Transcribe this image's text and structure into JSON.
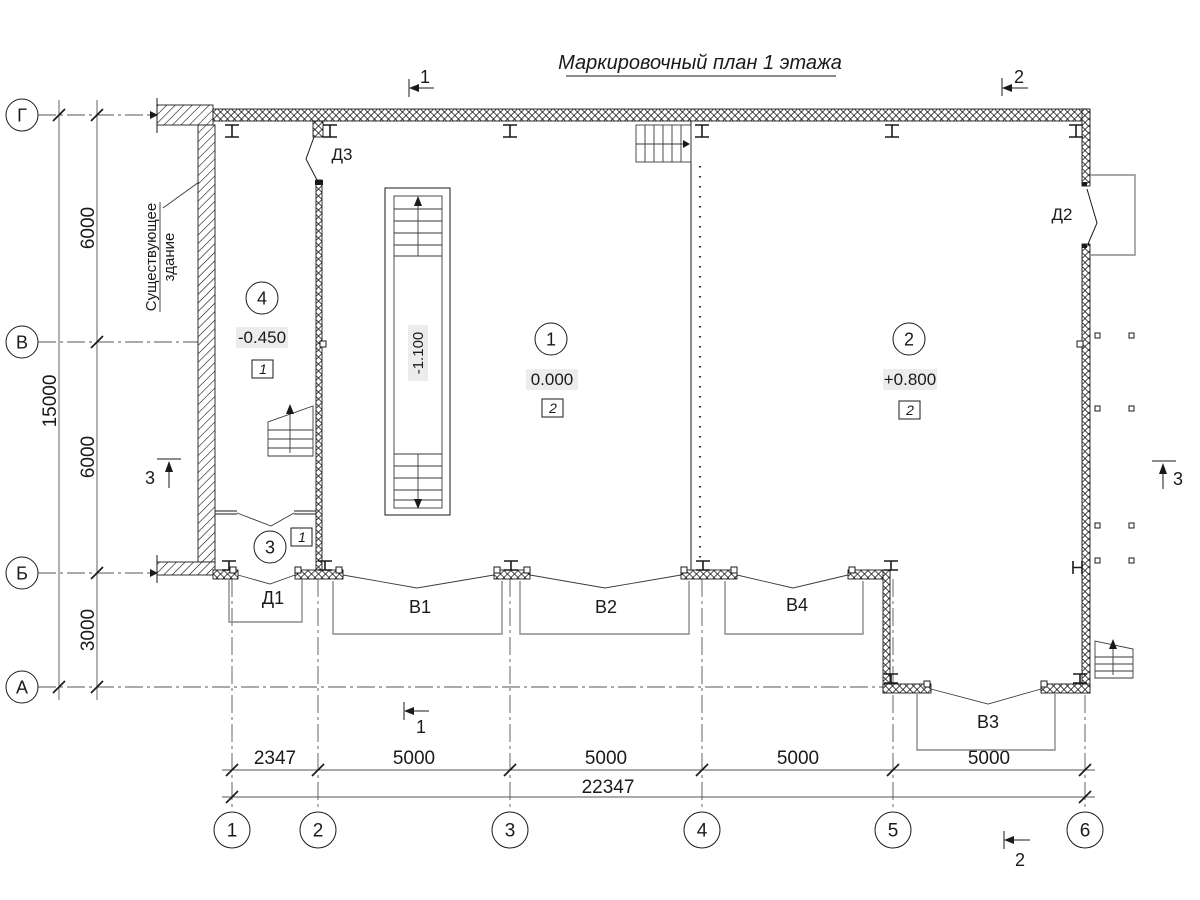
{
  "title": "Маркировочный план 1 этажа",
  "existing": {
    "line1": "Существующее",
    "line2": "здание"
  },
  "axes": {
    "cols": [
      "1",
      "2",
      "3",
      "4",
      "5",
      "6"
    ],
    "rows": [
      "Г",
      "В",
      "Б",
      "А"
    ]
  },
  "dims": {
    "h_segments": [
      "2347",
      "5000",
      "5000",
      "5000",
      "5000"
    ],
    "h_total": "22347",
    "v_segments": [
      "6000",
      "6000",
      "3000"
    ],
    "v_total": "15000"
  },
  "rooms": [
    {
      "num": "4",
      "elev": "-0.450",
      "type": "1"
    },
    {
      "num": "1",
      "elev": "0.000",
      "type": "2"
    },
    {
      "num": "2",
      "elev": "+0.800",
      "type": "2"
    },
    {
      "num": "3",
      "type": "1"
    }
  ],
  "pit": {
    "elev": "-1.100"
  },
  "doors": {
    "d1": "Д1",
    "d2": "Д2",
    "d3": "Д3"
  },
  "gates": {
    "v1": "В1",
    "v2": "В2",
    "v3": "В3",
    "v4": "В4"
  },
  "sections": {
    "s1": "1",
    "s2": "2",
    "s3": "3"
  }
}
